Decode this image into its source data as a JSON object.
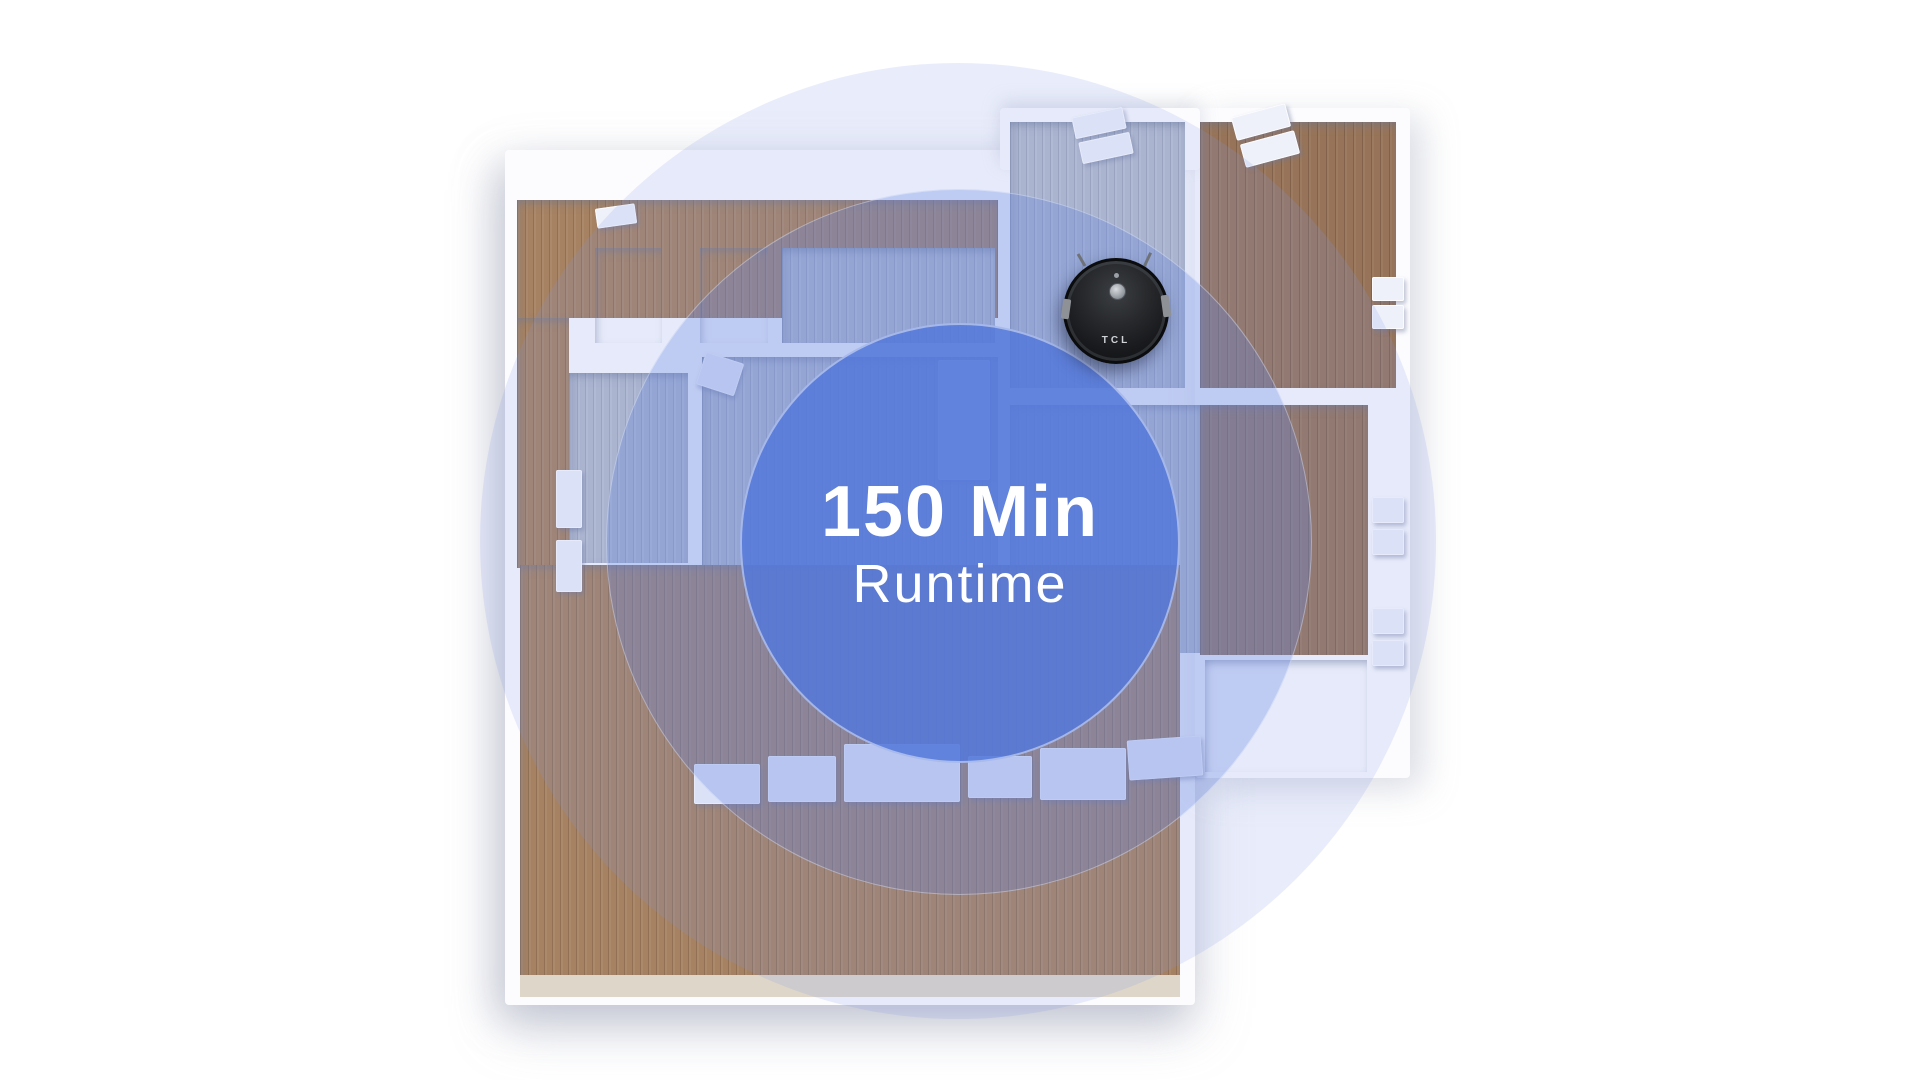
{
  "overlay": {
    "line1": "150 Min",
    "line2": "Runtime"
  },
  "robot": {
    "brand": "TCL"
  },
  "palette": {
    "inner_circle": "#5478da",
    "middle_circle": "rgba(99,132,224,0.30)",
    "outer_circle": "rgba(122,149,229,0.17)",
    "text": "#ffffff",
    "robot_body": "#191a1d",
    "wood_warm": "#a68262",
    "wood_dark": "#977459",
    "wood_gray": "#b4bbcb",
    "tile_beige": "#d7caae",
    "tile_white": "#f3f2ef",
    "walls": "#fcfcfe",
    "background": "#ffffff"
  }
}
